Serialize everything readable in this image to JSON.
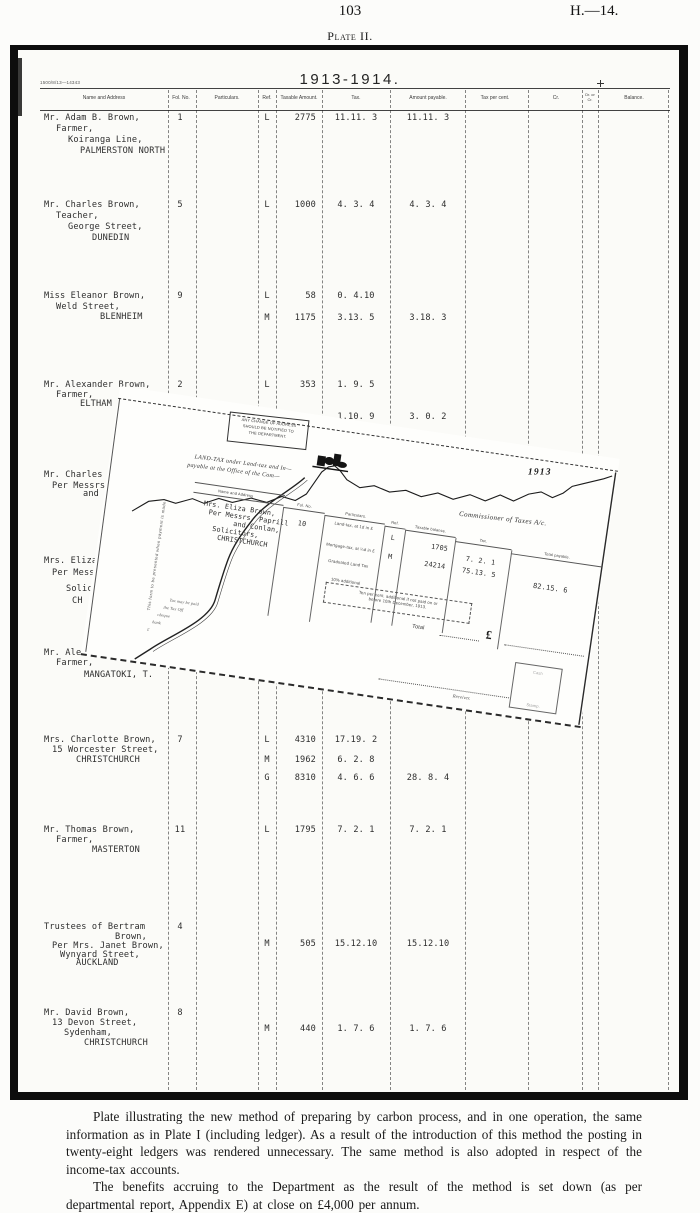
{
  "page": {
    "number": "103",
    "report_code": "H.—14.",
    "plate_title": "Plate II."
  },
  "plate": {
    "year_title": "1913-1914.",
    "form_code": "1500/8/13—14343",
    "columns": [
      "Name and Address",
      "Fol. No.",
      "Particulars.",
      "Ref.",
      "Taxable Amount.",
      "Tax.",
      "Amount payable.",
      "Tax per cent.",
      "Cr.",
      "Dr. or\nCr.",
      "Balance."
    ],
    "rows": [
      {
        "y": 113,
        "fol": "1",
        "name_lines": [
          {
            "x": 44,
            "dy": 0,
            "text": "Mr. Adam B. Brown,"
          },
          {
            "x": 56,
            "dy": 11,
            "text": "Farmer,"
          },
          {
            "x": 68,
            "dy": 22,
            "text": "Koiranga Line,"
          },
          {
            "x": 80,
            "dy": 33,
            "text": "PALMERSTON NORTH"
          }
        ],
        "entries": [
          {
            "dy": 0,
            "ref": "L",
            "taxable": "2775",
            "tax": "11.11. 3",
            "payable": "11.11. 3"
          }
        ]
      },
      {
        "y": 200,
        "fol": "5",
        "name_lines": [
          {
            "x": 44,
            "dy": 0,
            "text": "Mr. Charles Brown,"
          },
          {
            "x": 56,
            "dy": 11,
            "text": "Teacher,"
          },
          {
            "x": 68,
            "dy": 22,
            "text": "George Street,"
          },
          {
            "x": 92,
            "dy": 33,
            "text": "DUNEDIN"
          }
        ],
        "entries": [
          {
            "dy": 0,
            "ref": "L",
            "taxable": "1000",
            "tax": "4. 3. 4",
            "payable": "4. 3. 4"
          }
        ]
      },
      {
        "y": 291,
        "fol": "9",
        "name_lines": [
          {
            "x": 44,
            "dy": 0,
            "text": "Miss Eleanor Brown,"
          },
          {
            "x": 56,
            "dy": 11,
            "text": "Weld Street,"
          },
          {
            "x": 100,
            "dy": 21,
            "text": "BLENHEIM"
          }
        ],
        "entries": [
          {
            "dy": 0,
            "ref": "L",
            "taxable": "58",
            "tax": "0. 4.10"
          },
          {
            "dy": 22,
            "ref": "M",
            "taxable": "1175",
            "tax": "3.13. 5",
            "payable": "3.18. 3"
          }
        ]
      },
      {
        "y": 380,
        "fol": "2",
        "name_lines": [
          {
            "x": 44,
            "dy": 0,
            "text": "Mr. Alexander Brown,"
          },
          {
            "x": 56,
            "dy": 10,
            "text": "Farmer,"
          },
          {
            "x": 80,
            "dy": 19,
            "text": "ELTHAM"
          }
        ],
        "entries": [
          {
            "dy": 0,
            "ref": "L",
            "taxable": "353",
            "tax": "1. 9. 5"
          },
          {
            "dy": 32,
            "tax": "1.10. 9",
            "payable": "3. 0. 2"
          }
        ]
      },
      {
        "y": 470,
        "name_lines": [
          {
            "x": 44,
            "dy": 0,
            "text": "Mr. Charles A."
          },
          {
            "x": 52,
            "dy": 11,
            "text": "Per Messrs."
          },
          {
            "x": 83,
            "dy": 19,
            "text": "and"
          }
        ],
        "entries": []
      },
      {
        "y": 556,
        "name_lines": [
          {
            "x": 44,
            "dy": 0,
            "text": "Mrs. Eliza B"
          },
          {
            "x": 52,
            "dy": 12,
            "text": "Per Messr"
          },
          {
            "x": 66,
            "dy": 28,
            "text": "Solic"
          },
          {
            "x": 72,
            "dy": 40,
            "text": "CH"
          }
        ],
        "entries": []
      },
      {
        "y": 648,
        "name_lines": [
          {
            "x": 44,
            "dy": 0,
            "text": "Mr. Alex"
          },
          {
            "x": 56,
            "dy": 10,
            "text": "Farmer,"
          },
          {
            "x": 84,
            "dy": 22,
            "text": "MANGATOKI, T."
          }
        ],
        "entries": []
      },
      {
        "y": 735,
        "fol": "7",
        "name_lines": [
          {
            "x": 44,
            "dy": 0,
            "text": "Mrs. Charlotte Brown,"
          },
          {
            "x": 52,
            "dy": 10,
            "text": "15 Worcester Street,"
          },
          {
            "x": 76,
            "dy": 20,
            "text": "CHRISTCHURCH"
          }
        ],
        "entries": [
          {
            "dy": 0,
            "ref": "L",
            "taxable": "4310",
            "tax": "17.19. 2"
          },
          {
            "dy": 20,
            "ref": "M",
            "taxable": "1962",
            "tax": "6. 2. 8"
          },
          {
            "dy": 38,
            "ref": "G",
            "taxable": "8310",
            "tax": "4. 6. 6",
            "payable": "28. 8. 4"
          }
        ]
      },
      {
        "y": 825,
        "fol": "11",
        "name_lines": [
          {
            "x": 44,
            "dy": 0,
            "text": "Mr. Thomas Brown,"
          },
          {
            "x": 56,
            "dy": 10,
            "text": "Farmer,"
          },
          {
            "x": 92,
            "dy": 20,
            "text": "MASTERTON"
          }
        ],
        "entries": [
          {
            "dy": 0,
            "ref": "L",
            "taxable": "1795",
            "tax": "7. 2. 1",
            "payable": "7. 2. 1"
          }
        ]
      },
      {
        "y": 922,
        "fol": "4",
        "name_lines": [
          {
            "x": 44,
            "dy": 0,
            "text": "Trustees of Bertram"
          },
          {
            "x": 115,
            "dy": 10,
            "text": "Brown,"
          },
          {
            "x": 52,
            "dy": 19,
            "text": "Per Mrs. Janet Brown,"
          },
          {
            "x": 60,
            "dy": 28,
            "text": "Wynyard Street,"
          },
          {
            "x": 76,
            "dy": 36,
            "text": "AUCKLAND"
          }
        ],
        "entries": [
          {
            "dy": 17,
            "ref": "M",
            "taxable": "505",
            "tax": "15.12.10",
            "payable": "15.12.10"
          }
        ]
      },
      {
        "y": 1008,
        "fol": "8",
        "name_lines": [
          {
            "x": 44,
            "dy": 0,
            "text": "Mr. David Brown,"
          },
          {
            "x": 52,
            "dy": 10,
            "text": "13 Devon Street,"
          },
          {
            "x": 64,
            "dy": 20,
            "text": "Sydenham,"
          },
          {
            "x": 84,
            "dy": 30,
            "text": "CHRISTCHURCH"
          }
        ],
        "entries": [
          {
            "dy": 16,
            "ref": "M",
            "taxable": "440",
            "tax": "1. 7. 6",
            "payable": "1. 7. 6"
          }
        ]
      }
    ]
  },
  "overlay": {
    "stamp_note": [
      "ANY CHANGE OF ADDRESS",
      "SHOULD BE NOTIFIED TO",
      "THE DEPARTMENT."
    ],
    "heading_line1": "LAND-TAX under Land-tax and In—",
    "heading_line2": "payable at the Office of the Com—",
    "year_mark": "1913",
    "account_title": "Commissioner of Taxes A/c.",
    "columns": [
      "Name and Address",
      "Fol. No.",
      "Particulars.",
      "Ref.",
      "Taxable balance.",
      "Tax.",
      "Total payable."
    ],
    "name_lines": [
      "Mrs. Eliza Brown,",
      "Per Messrs. Paprill",
      "and Conlan,",
      "Solicitors,",
      "CHRISTCHURCH"
    ],
    "fol": "10",
    "particulars": [
      "Land-tax, at 1d in £",
      "Mortgage-tax, at ¼d in £",
      "Graduated Land Tax",
      "10% additional"
    ],
    "entries": [
      {
        "ref": "L",
        "taxable": "1705",
        "tax": "7. 2. 1"
      },
      {
        "ref": "M",
        "taxable": "24214",
        "tax": "75.13. 5"
      }
    ],
    "total_payable": "82.15. 6",
    "penalty_note_line1": "Ten per cent. additional if not paid on or",
    "penalty_note_line2": "before 10th December, 1913.",
    "total_label": "Total",
    "currency_sign": "£",
    "receiver_label": "Receiver.",
    "side_note": "This form to be presented when payment is made.",
    "pay_note_fragments": [
      "Tax may be paid",
      "the Tax Off",
      "cheque",
      "bank",
      "£"
    ],
    "stamp_box": {
      "top": "Cash",
      "bottom": "Stamp."
    }
  },
  "caption": {
    "para1": "Plate illustrating the new method of preparing by carbon process, and in one operation, the same information as in Plate I (including ledger).  As a result of the introduction of this method the posting in twenty-eight ledgers was rendered unnecessary.  The same method is also adopted in respect of the income-tax accounts.",
    "para2": "The benefits accruing to the Department as the result of the method is set down (as per departmental report, Appendix E) at close on £4,000 per annum."
  }
}
